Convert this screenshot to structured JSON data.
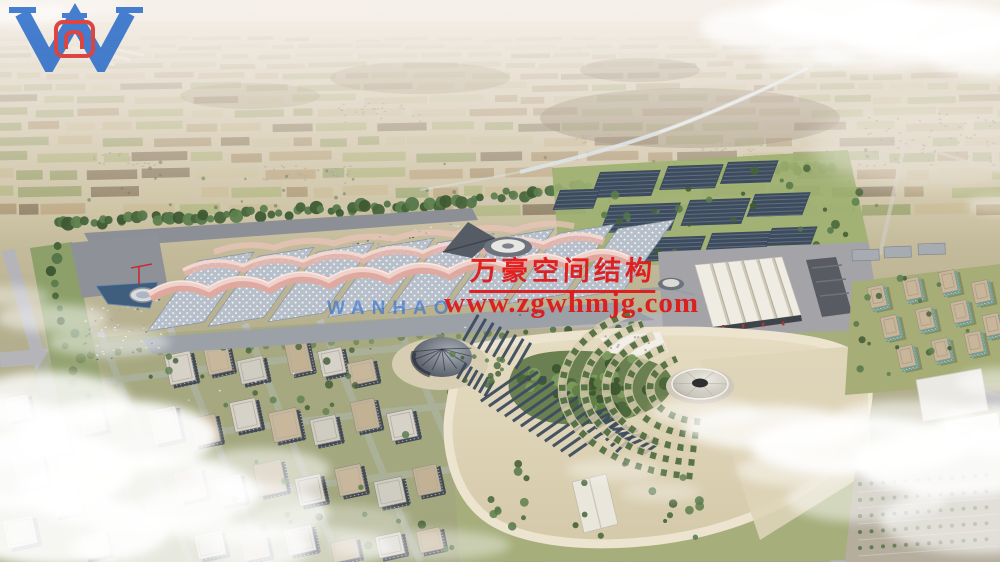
{
  "watermark": {
    "company_name_cn": "万豪空间结构",
    "website": "www.zgwhmjg.com",
    "logo_letter": "W",
    "logo_name": "WANHAO",
    "text_red": "#e11414",
    "logo_blue": "#1f64c8",
    "emblem_red": "#d62222"
  },
  "icons": {
    "logo": "wanhao-w-logo"
  },
  "palette": {
    "haze": "#f4efe8",
    "field_green": "#94a268",
    "field_tan": "#c4b78d",
    "tree_green": "#4e6b3e",
    "hall_roof": "#b6bfca",
    "canopy_pink": "#e0a89d",
    "road_gray": "#b5b5b9",
    "plaza_tan": "#e2d8bd",
    "panel_dark": "#3c4c5e",
    "river_blue": "#d4e2e8",
    "lawn": "#a6ae7c",
    "cloud": "#ffffff"
  }
}
